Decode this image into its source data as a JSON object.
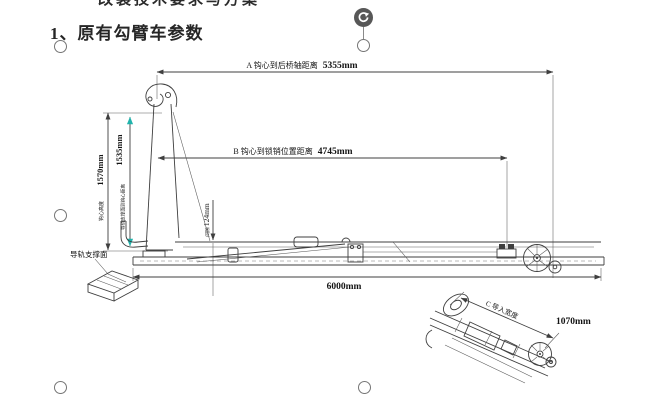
{
  "document": {
    "clipped_heading_fragment": "改装技术要求与方案",
    "section_title": "1、原有勾臂车参数"
  },
  "selection": {
    "rotate_icon": "rotate-clockwise-icon",
    "handle_shape": "circle"
  },
  "drawing": {
    "dim_a_label": "A 钩心到后桥轴距离",
    "dim_a_value": "5355mm",
    "dim_b_label": "B 钩心到锁销位置距离",
    "dim_b_value": "4745mm",
    "dim_hook_height_value": "1570mm",
    "dim_hook_height_label": "钩心高度",
    "dim_rail_to_hook_value": "1535mm",
    "dim_rail_to_hook_label": "导轨支撑面到钩心距离",
    "dim_gap_label": "间隙",
    "dim_gap_value": "124mm",
    "dim_overall_length_value": "6000mm",
    "dim_c_label": "C 导入宽度",
    "dim_c_value": "1070mm",
    "rail_surface_label": "导轨支撑面"
  },
  "colors": {
    "teal_accent": "#1fb3ac",
    "line": "#3f3f3f",
    "handle_border": "#757575",
    "rotate_handle_bg": "#575757"
  }
}
